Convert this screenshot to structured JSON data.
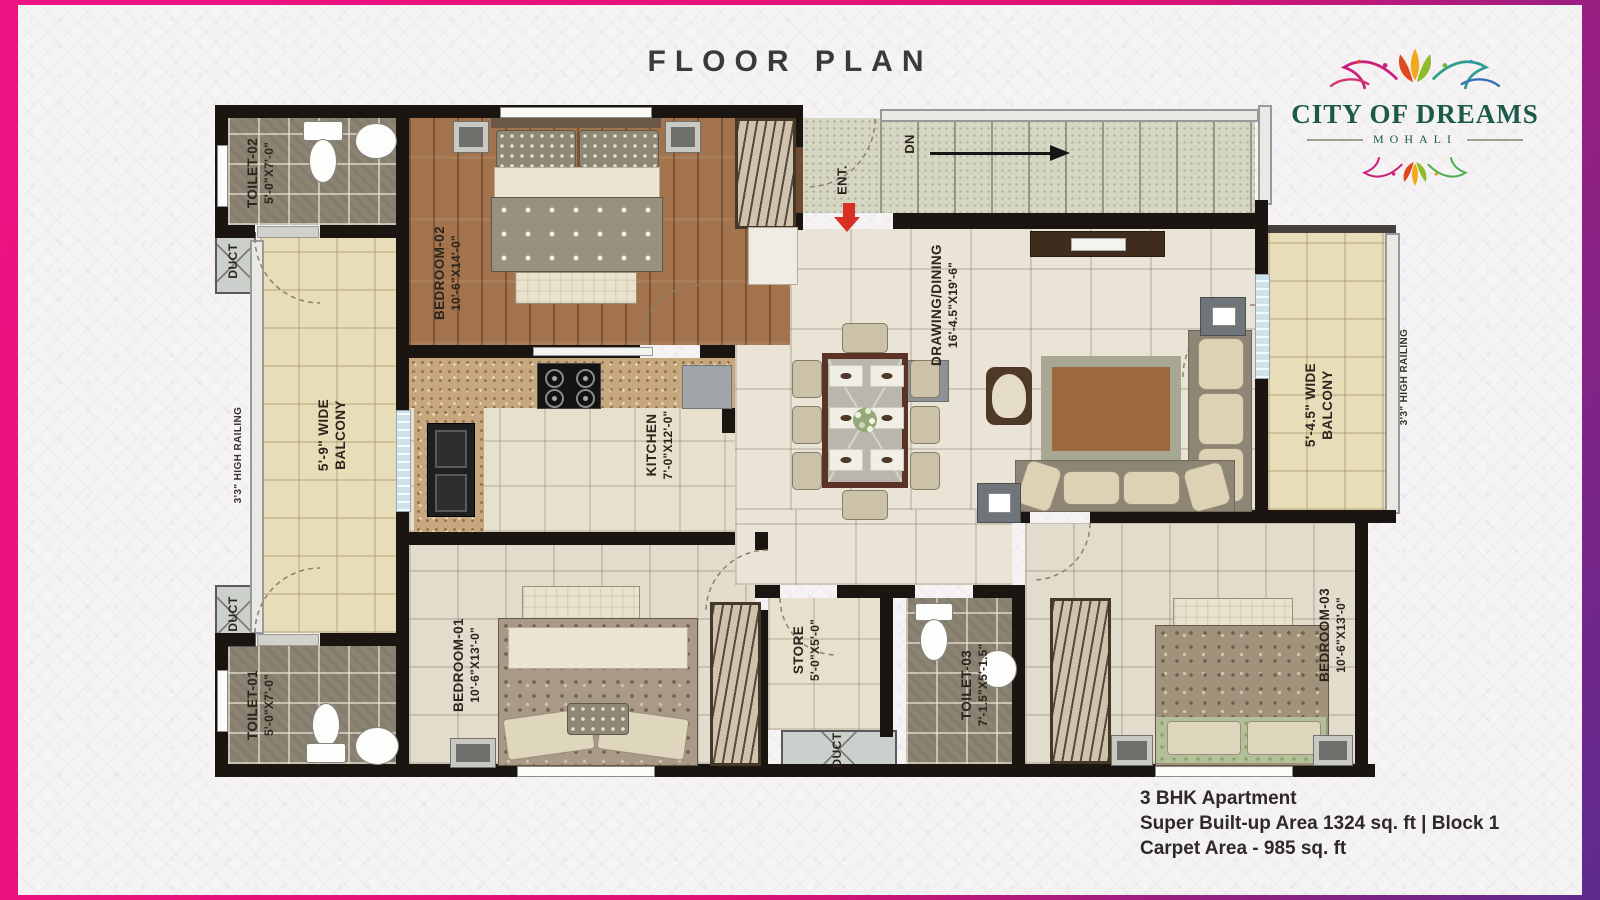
{
  "header": {
    "title": "FLOOR PLAN"
  },
  "logo": {
    "name": "CITY OF DREAMS",
    "city": "MOHALI"
  },
  "summary": {
    "line1": "3 BHK Apartment",
    "line2": "Super Built-up Area 1324 sq. ft | Block 1",
    "line3": "Carpet Area - 985 sq. ft"
  },
  "plan": {
    "toilet02": {
      "name": "TOILET-02",
      "dims": "5'-0\"X7'-0\""
    },
    "toilet01": {
      "name": "TOILET-01",
      "dims": "5'-0\"X7'-0\""
    },
    "toilet03": {
      "name": "TOILET-03",
      "dims": "7'-1.5\"X5'-1.5\""
    },
    "bedroom02": {
      "name": "BEDROOM-02",
      "dims": "10'-6\"X14'-0\""
    },
    "bedroom01": {
      "name": "BEDROOM-01",
      "dims": "10'-6\"X13'-0\""
    },
    "bedroom03": {
      "name": "BEDROOM-03",
      "dims": "10'-6\"X13'-0\""
    },
    "kitchen": {
      "name": "KITCHEN",
      "dims": "7'-0\"X12'-0\""
    },
    "drawing": {
      "name": "DRAWING/DINING",
      "dims": "16'-4.5\"X19'-6\""
    },
    "store": {
      "name": "STORE",
      "dims": "5'-0\"X5'-0\""
    },
    "balcony_left": {
      "line1": "5'-9\" WIDE",
      "line2": "BALCONY"
    },
    "balcony_right": {
      "line1": "5'-4.5\" WIDE",
      "line2": "BALCONY"
    },
    "railing": "3'3\" HIGH RAILING",
    "duct": "DUCT",
    "ent": "ENT.",
    "dn": "DN"
  },
  "colors": {
    "accent_pink": "#ef1283",
    "accent_purple": "#5d2b8e",
    "logo_green": "#1b5948",
    "wall": "#1b1511",
    "ent_arrow_red": "#d93025"
  }
}
